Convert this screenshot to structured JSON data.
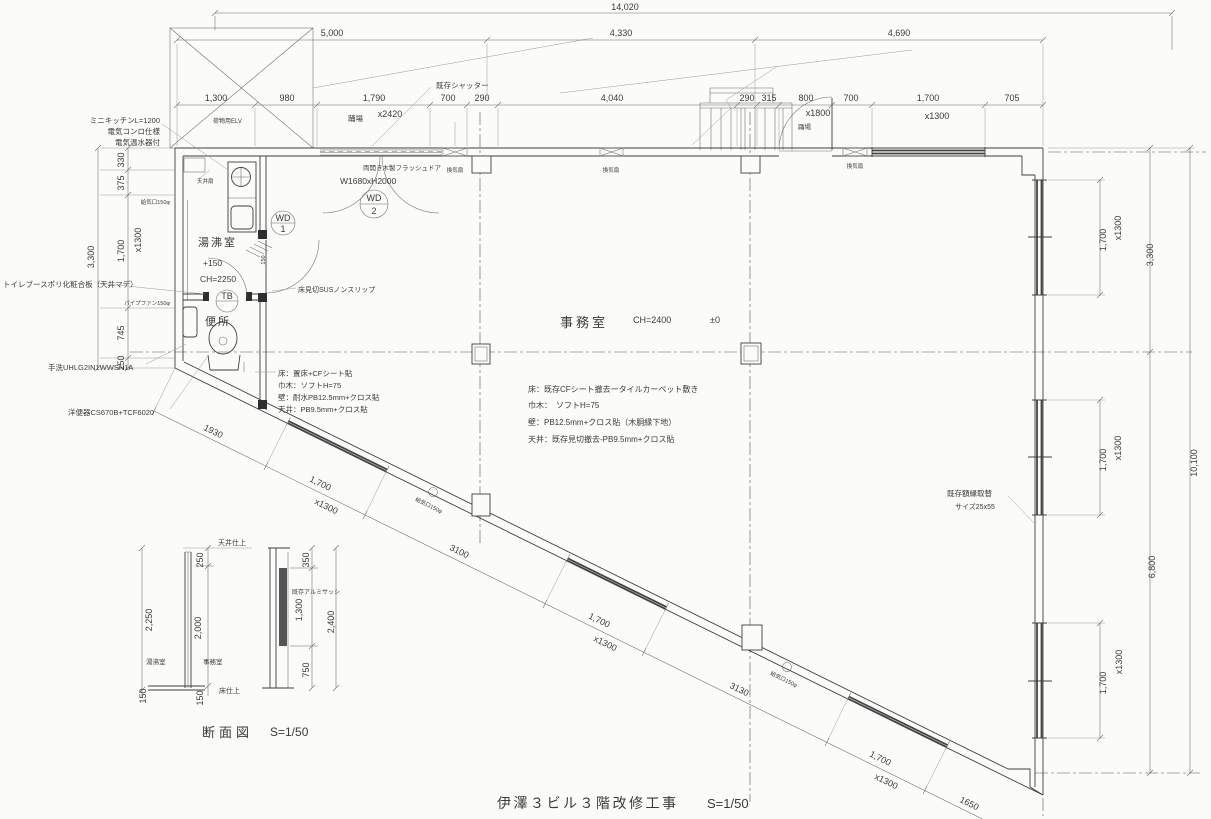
{
  "drawing": {
    "title": "伊澤３ビル３階改修工事",
    "title_scale": "S=1/50"
  },
  "dims_top": {
    "total": "14,020",
    "row1": [
      "5,000",
      "4,330",
      "4,690"
    ],
    "row2": [
      "1,300",
      "980",
      "1,790",
      "700",
      "290",
      "4,040",
      "290",
      "315",
      "800",
      "700",
      "1,700",
      "705"
    ],
    "shutter_size": "x2420",
    "door_size": "x1800",
    "window_size": "x1300"
  },
  "dims_left": {
    "total": "3,300",
    "segs": [
      "330",
      "375",
      "1,700",
      "745",
      "150"
    ],
    "win": "x1300"
  },
  "dims_right": {
    "total": "10,100",
    "upper": "3,300",
    "lower": "6,800",
    "win1": "1,700",
    "win1s": "x1300",
    "win2": "1,700",
    "win2s": "x1300",
    "win3": "1,700",
    "win3s": "x1300"
  },
  "dims_diag": {
    "segs": [
      "1930",
      "1,700",
      "3100",
      "1,700",
      "3130",
      "1,700",
      "1650"
    ],
    "win": "x1300"
  },
  "rooms": {
    "office": {
      "name": "事務室",
      "ch": "CH=2400",
      "level": "±0"
    },
    "kitchen": {
      "name": "湯沸室",
      "level": "+150",
      "ch": "CH=2250"
    },
    "toilet": {
      "name": "便所"
    }
  },
  "notes_toilet": [
    "床：置床+CFシート貼",
    "巾木：ソフトH=75",
    "壁：耐水PB12.5mm+クロス貼",
    "天井：PB9.5mm+クロス貼"
  ],
  "notes_office": [
    "床：既存CFシート撤去ータイルカーペット敷き",
    "巾木：　ソフトH=75",
    "壁：PB12.5mm+クロス貼（木胴縁下地）",
    "天井：既存見切撤去-PB9.5mm+クロス貼"
  ],
  "labels": {
    "shutter": "既存シャッター",
    "elv": "荷物用ELV",
    "landing_top": "踊場",
    "landing_right": "踊場",
    "kitchen1": "ミニキッチンL=1200",
    "kitchen2": "電気コンロ仕様",
    "kitchen3": "電気温水器付",
    "booth": "トイレブースポリ化粧合板（天井マデ）",
    "handwash": "手洗UHLG2IN1WWSN1A",
    "toilet_fixture": "洋便器CS670B+TCF6020",
    "threshold": "床見切SUSノンスリップ",
    "frame1": "既存額縁取替",
    "frame2": "サイズ25x55",
    "vent_fan": "換気扇",
    "ceiling_fan": "天井扇",
    "supply_vent": "給気口150φ",
    "pipe_fan": "パイプファン150φ",
    "door_label1": "両開き木製フラッシュドア",
    "door_label2": "W1680xH2000",
    "wd": "WD",
    "wd1n": "1",
    "wd2n": "2",
    "tb": "TB",
    "step150": "150"
  },
  "section": {
    "title": "断面図",
    "scale": "S=1/50",
    "ceiling": "天井仕上",
    "floor": "床仕上",
    "room_l": "湯沸室",
    "room_r": "事務室",
    "sash": "既存アルミサッシ",
    "d250": "250",
    "d2250": "2,250",
    "d2000": "2,000",
    "d150a": "150",
    "d150b": "150",
    "d350": "350",
    "d1300": "1,300",
    "d2400": "2,400",
    "d750": "750"
  }
}
